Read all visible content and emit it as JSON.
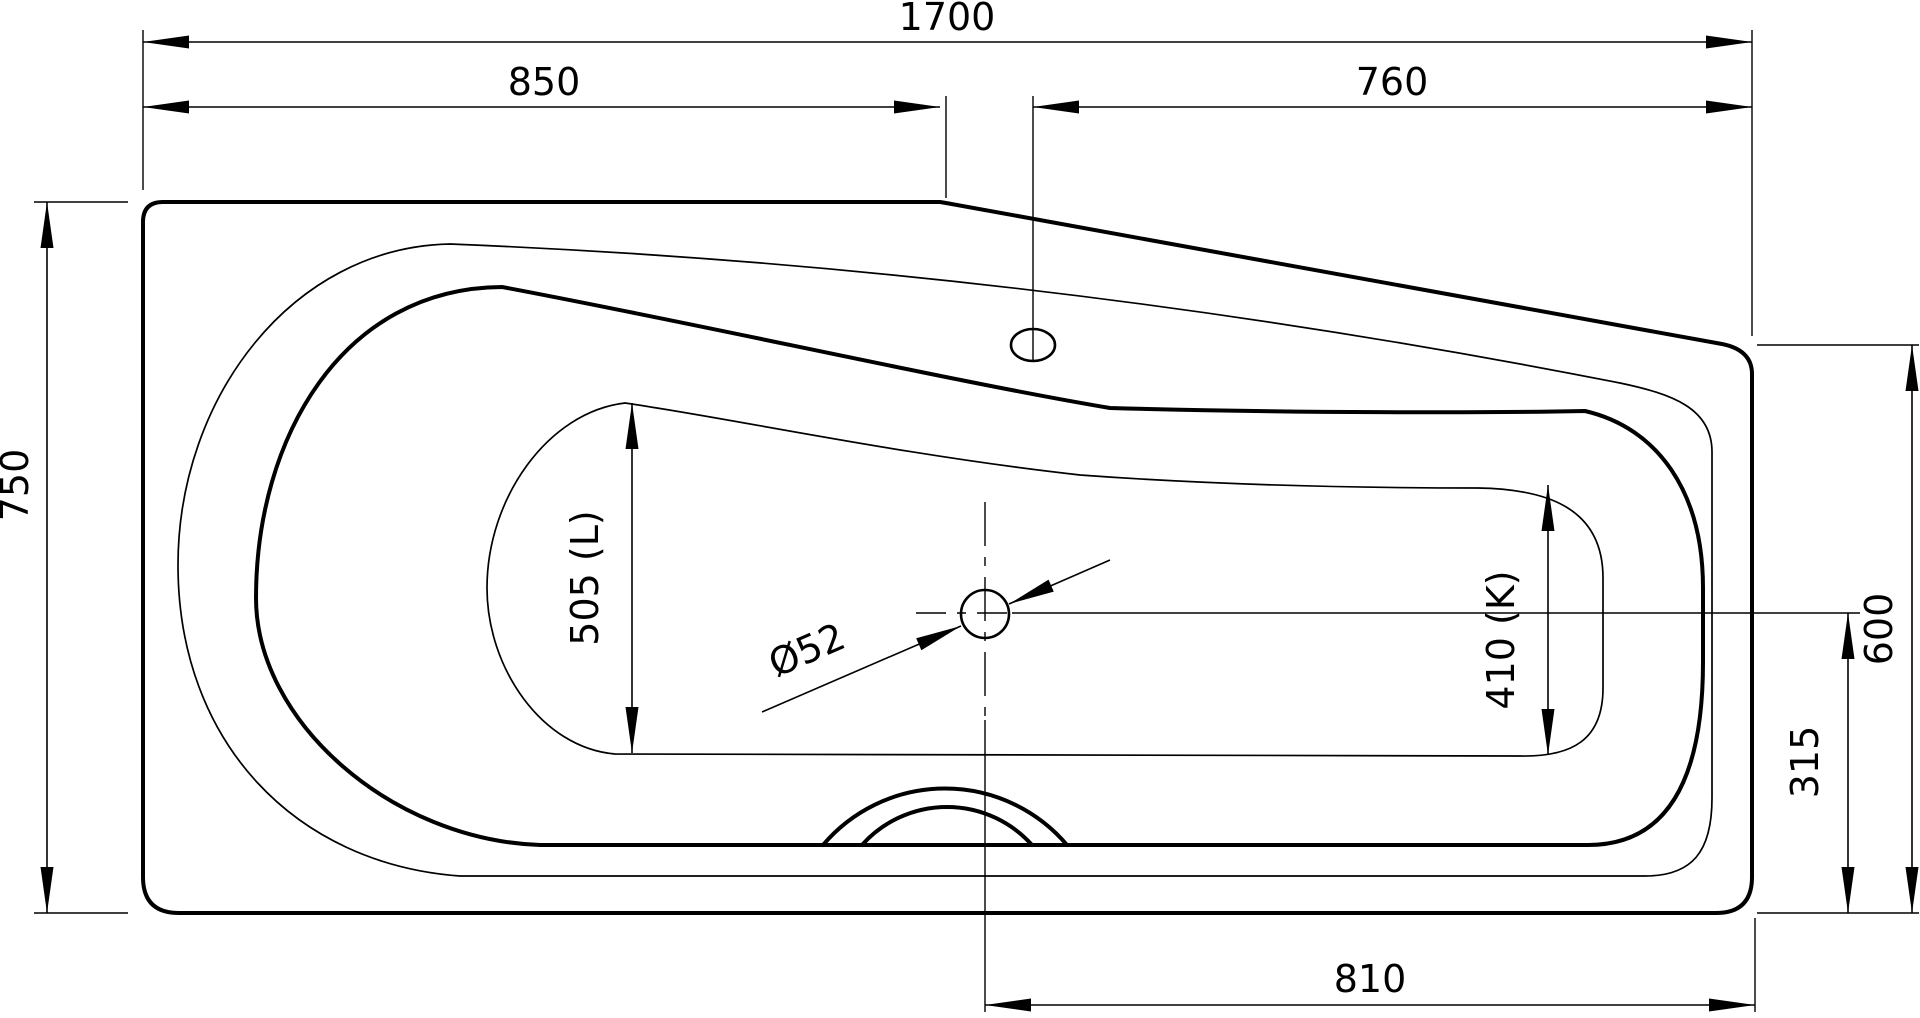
{
  "drawing": {
    "description": "Bathtub plan view technical drawing",
    "background": "#ffffff",
    "line_color": "#000000",
    "labels": {
      "overall_length": "1700",
      "left_edge_to_deck_step": "850",
      "overflow_to_right_end": "760",
      "width_left_end": "750",
      "inner_length_left": "505 (L)",
      "inner_width_right": "410 (K)",
      "drain_diameter": "Ø52",
      "width_right_end": "600",
      "drain_to_bottom_edge": "315",
      "drain_to_right_end": "810"
    }
  }
}
